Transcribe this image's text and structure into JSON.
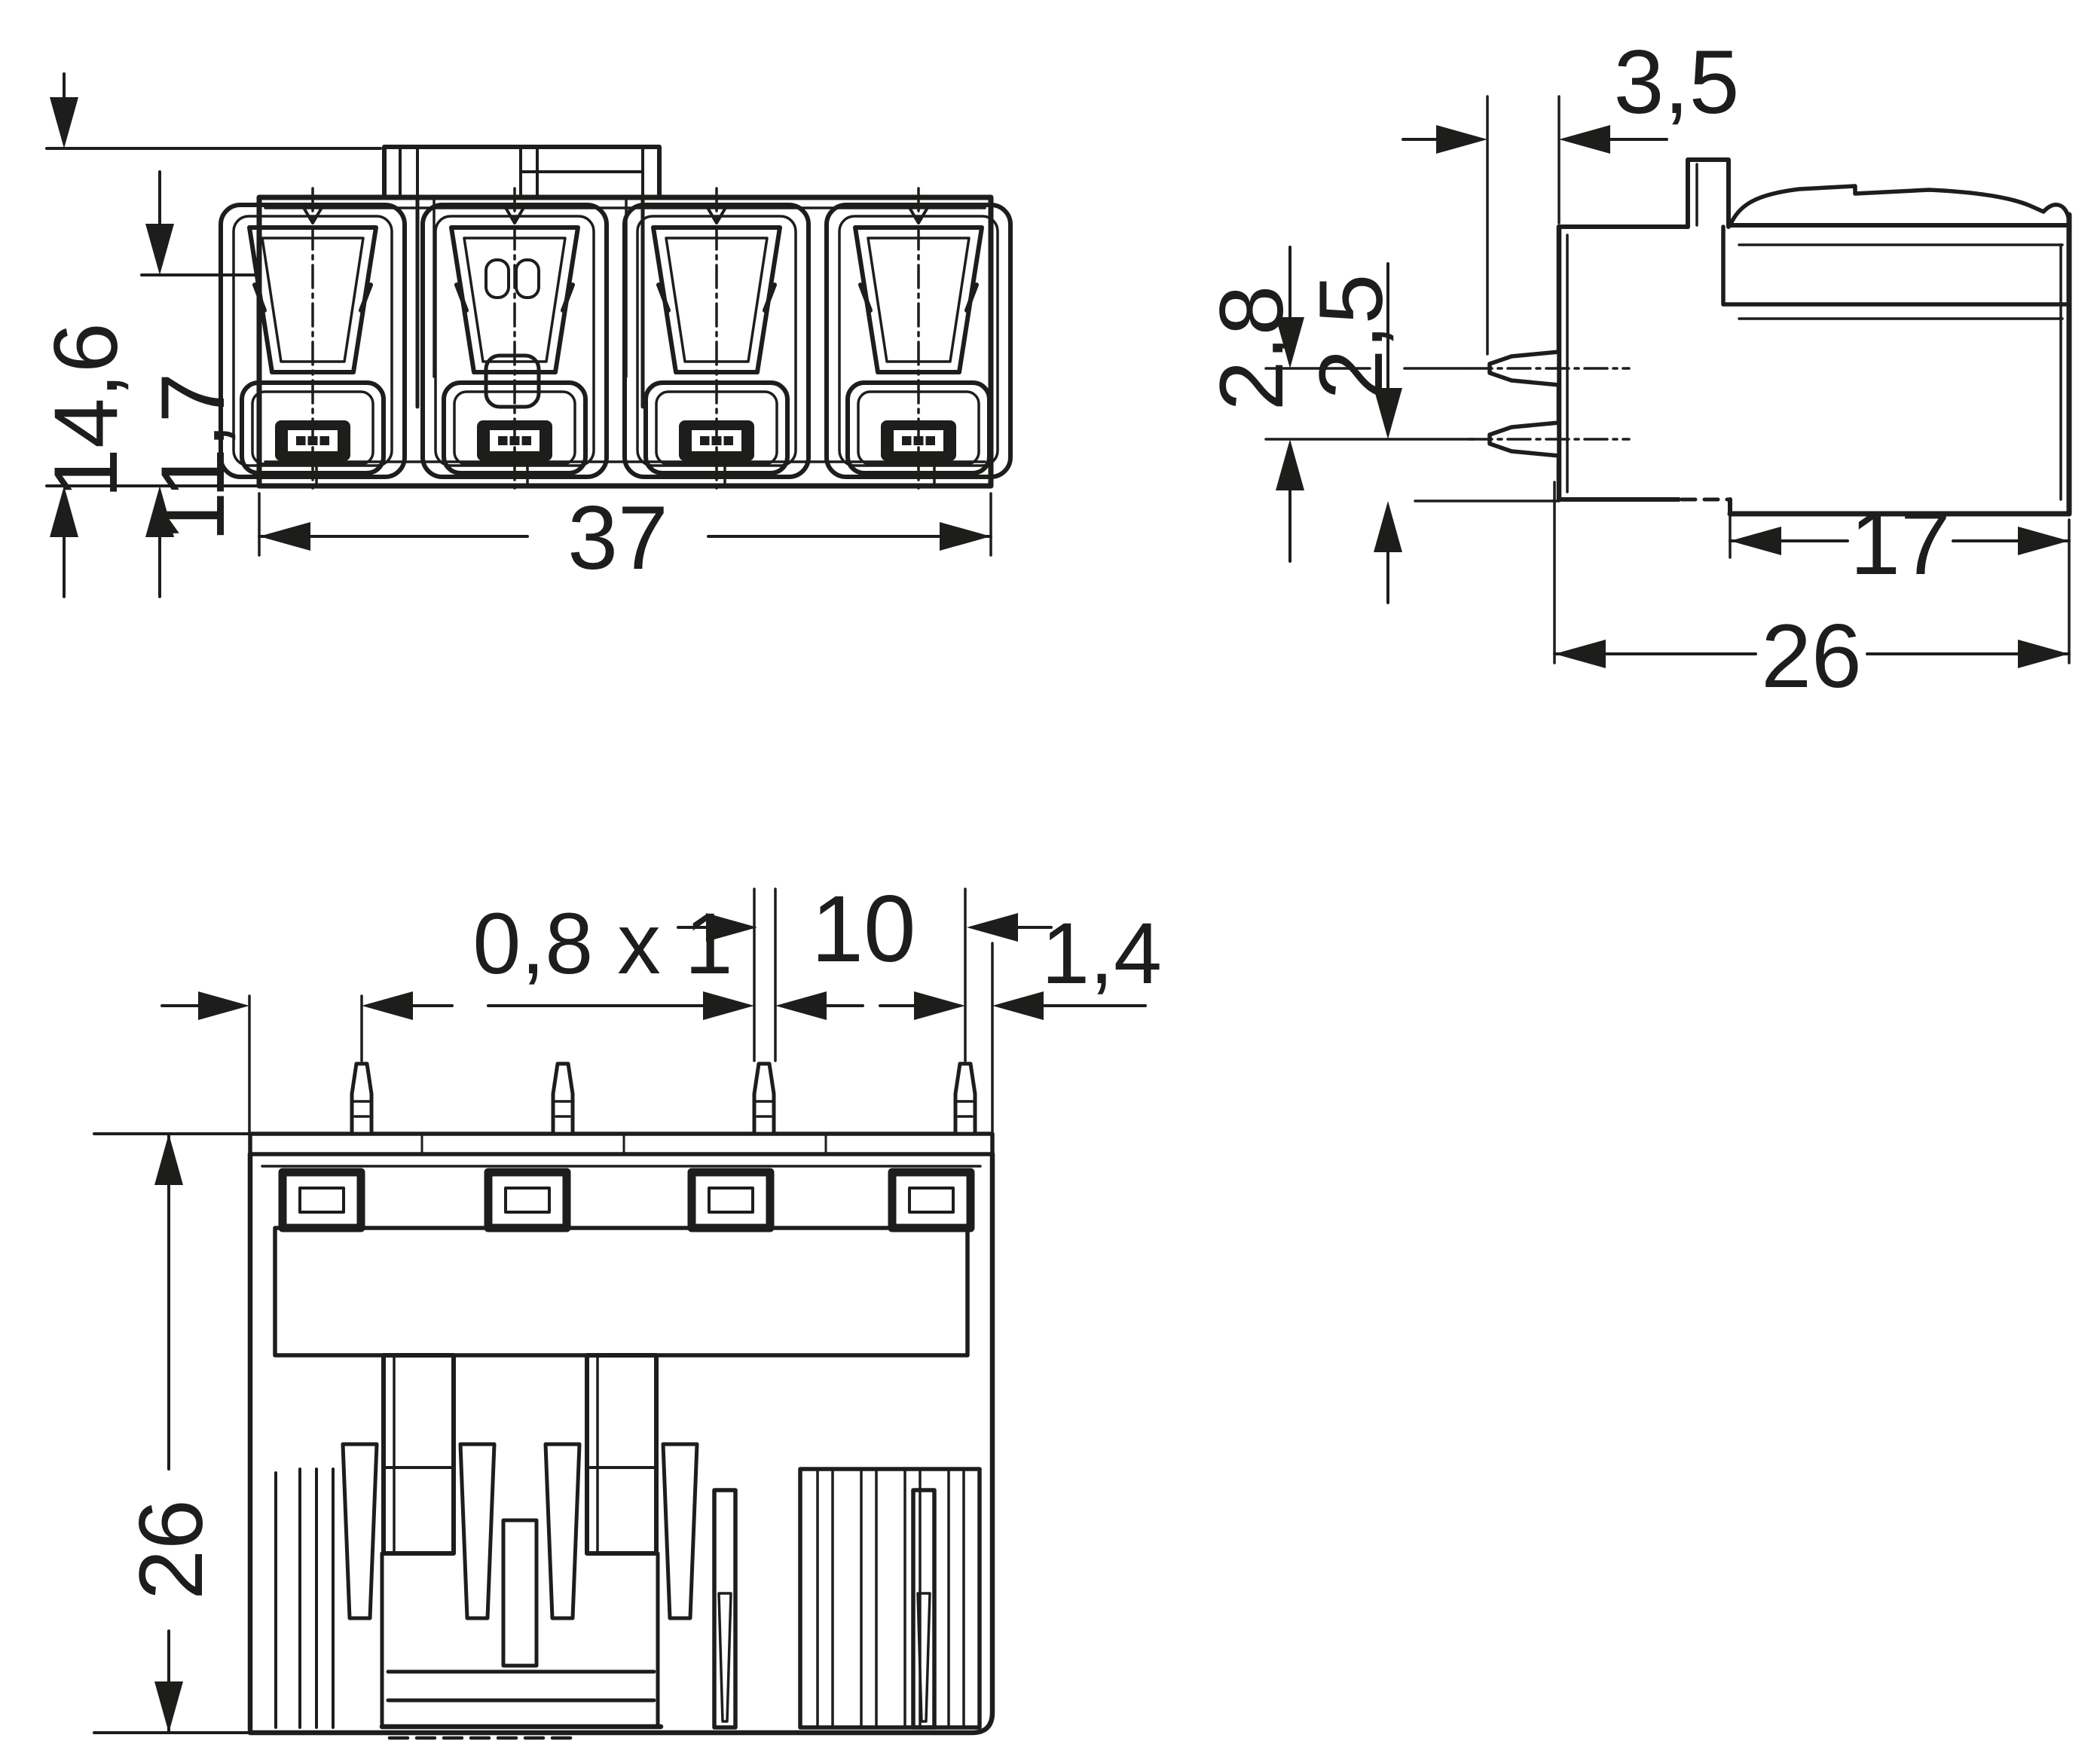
{
  "drawing": {
    "type": "technical-dimensional-drawing",
    "subject": "4-pole PCB connector, three orthographic views",
    "background_color": "#ffffff",
    "line_color": "#1d1d1b",
    "views": {
      "front": {
        "name": "front-view",
        "dimensions": {
          "height_overall": {
            "label": "14,6"
          },
          "height_body": {
            "label": "11,7"
          },
          "width_overall": {
            "label": "37"
          }
        }
      },
      "side": {
        "name": "side-view",
        "dimensions": {
          "pin_length": {
            "label": "3,5"
          },
          "pin_row_spacing": {
            "label": "2,8"
          },
          "pin_row_to_face": {
            "label": "2,5"
          },
          "depth_lower_body": {
            "label": "17"
          },
          "depth_overall": {
            "label": "26"
          }
        }
      },
      "bottom": {
        "name": "bottom-view",
        "dimensions": {
          "pin_cross_section": {
            "label": "0,8 x 1"
          },
          "pin_pitch": {
            "label": "10"
          },
          "pin_to_edge": {
            "label": "1,4"
          },
          "depth_overall": {
            "label": "26"
          }
        }
      }
    }
  }
}
